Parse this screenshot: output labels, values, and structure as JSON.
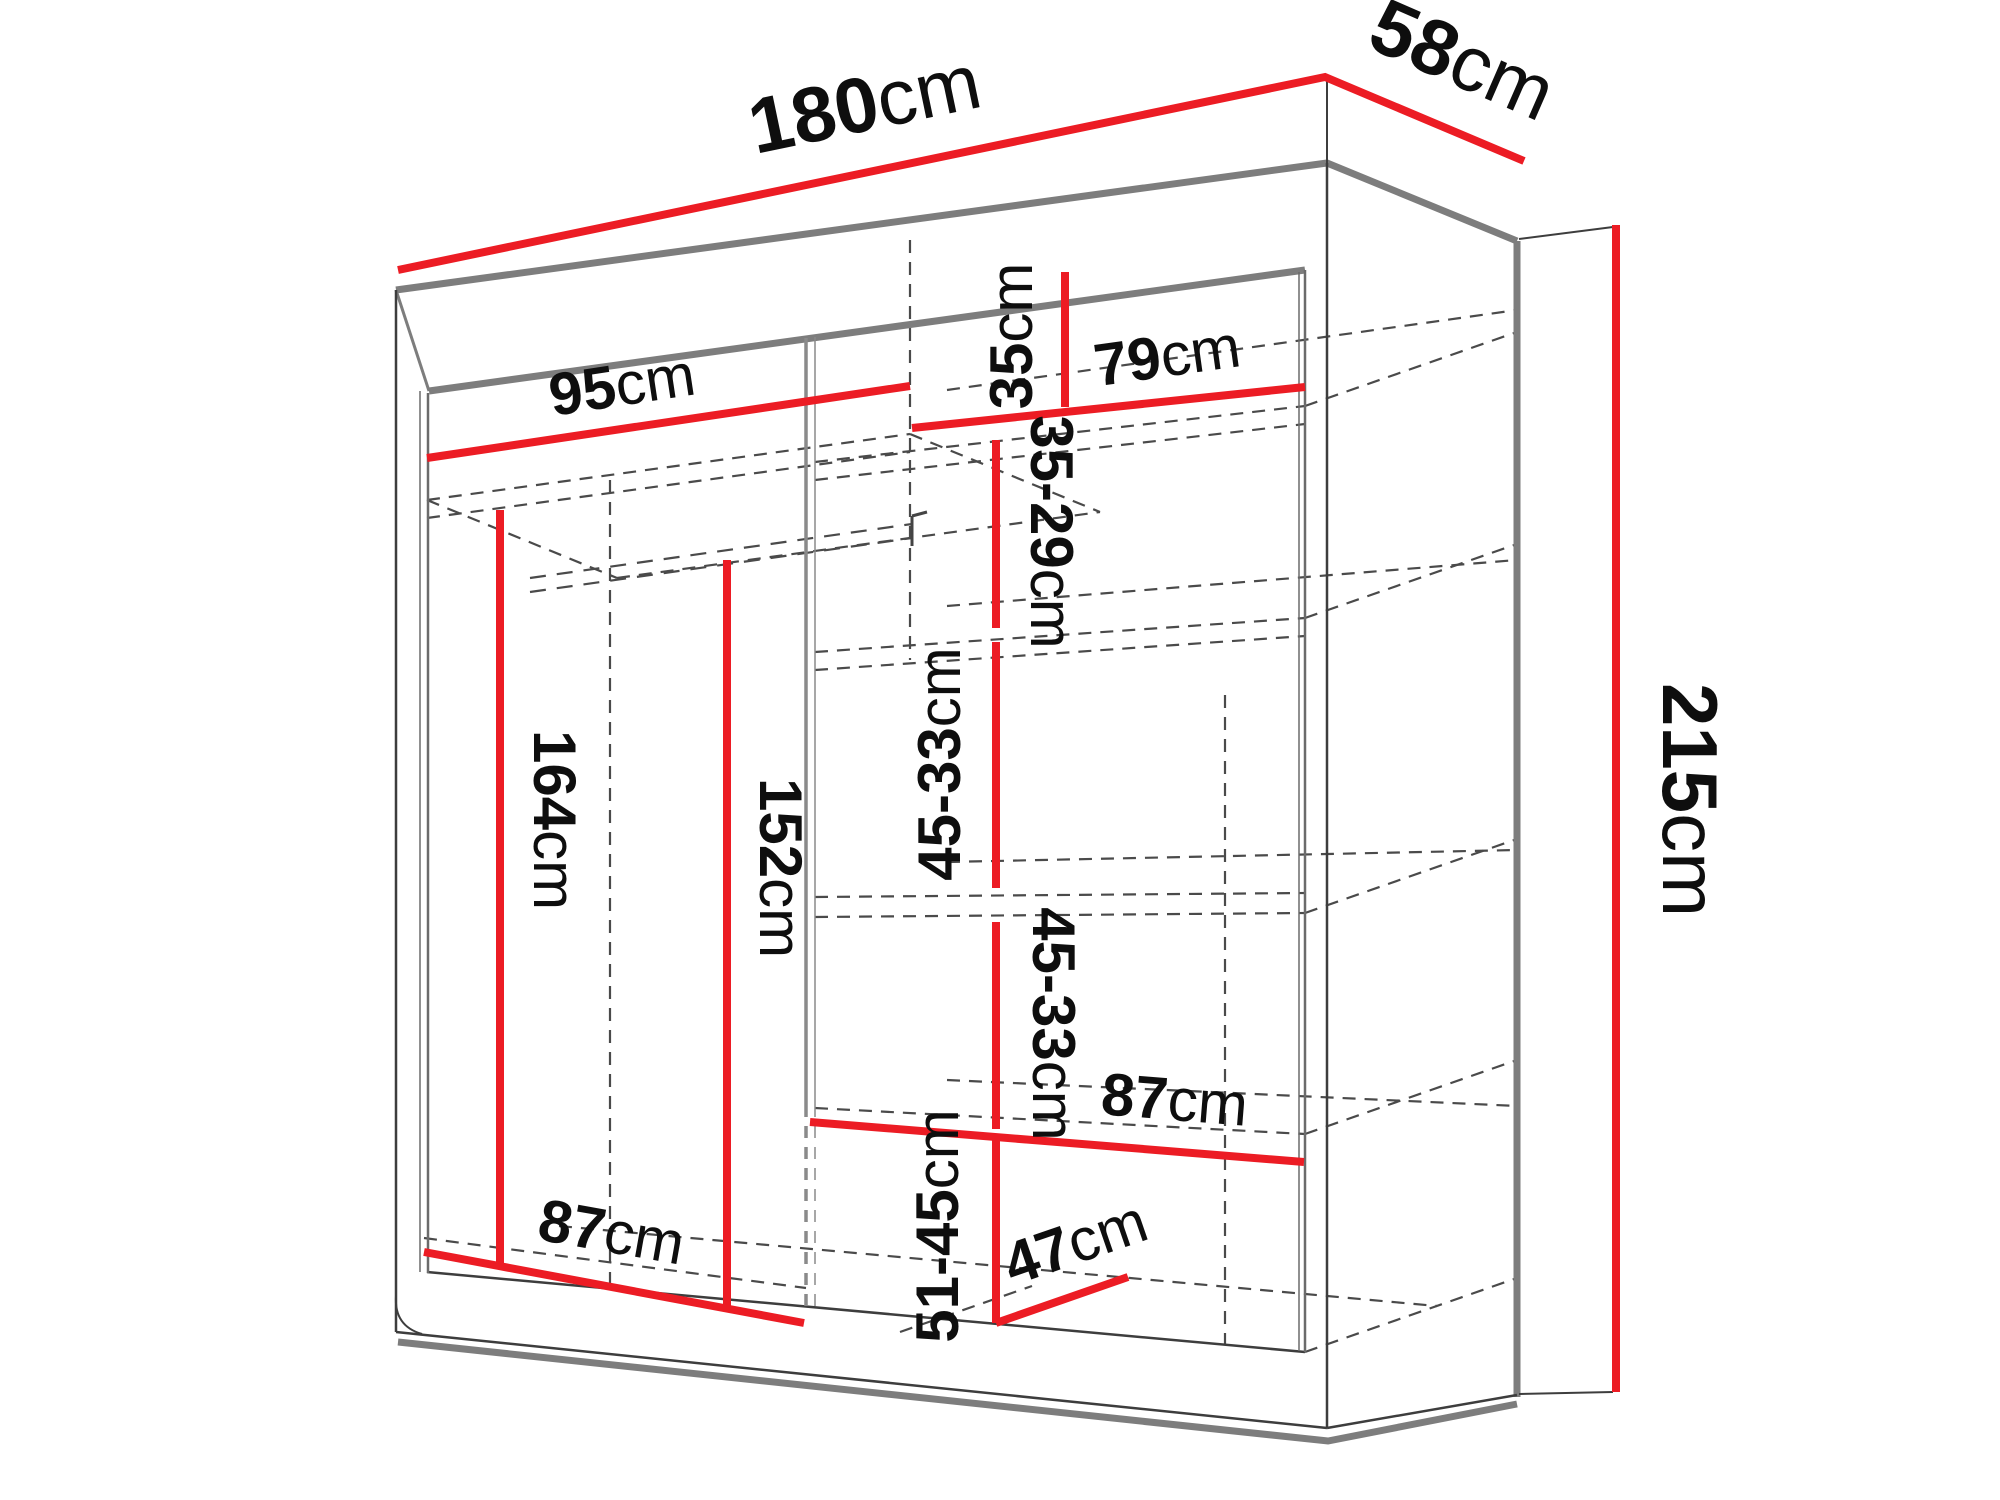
{
  "diagram": {
    "type": "furniture-dimension-diagram",
    "subject": "sliding-door wardrobe with shelves",
    "unit": "cm",
    "accent_color": "#ec1c24",
    "structure_color": "#7d7d7d",
    "dash_color": "#4a4a4a",
    "text_color": "#0e0e0e",
    "background_color": "#ffffff"
  },
  "dimensions": {
    "width_total": {
      "value": "180",
      "unit": "cm"
    },
    "depth_total": {
      "value": "58",
      "unit": "cm"
    },
    "height_total": {
      "value": "215",
      "unit": "cm"
    },
    "left_top_width": {
      "value": "95",
      "unit": "cm"
    },
    "top_right_height": {
      "value": "35",
      "unit": "cm"
    },
    "right_shelf_width": {
      "value": "79",
      "unit": "cm"
    },
    "shelf_space_1": {
      "value": "35-29",
      "unit": "cm"
    },
    "shelf_space_2": {
      "value": "45-33",
      "unit": "cm"
    },
    "shelf_space_3": {
      "value": "45-33",
      "unit": "cm"
    },
    "right_bottom_width": {
      "value": "87",
      "unit": "cm"
    },
    "bottom_space": {
      "value": "51-45",
      "unit": "cm"
    },
    "inner_depth": {
      "value": "47",
      "unit": "cm"
    },
    "left_height_rod": {
      "value": "164",
      "unit": "cm"
    },
    "left_height_shelf": {
      "value": "152",
      "unit": "cm"
    },
    "left_bottom_width": {
      "value": "87",
      "unit": "cm"
    }
  }
}
